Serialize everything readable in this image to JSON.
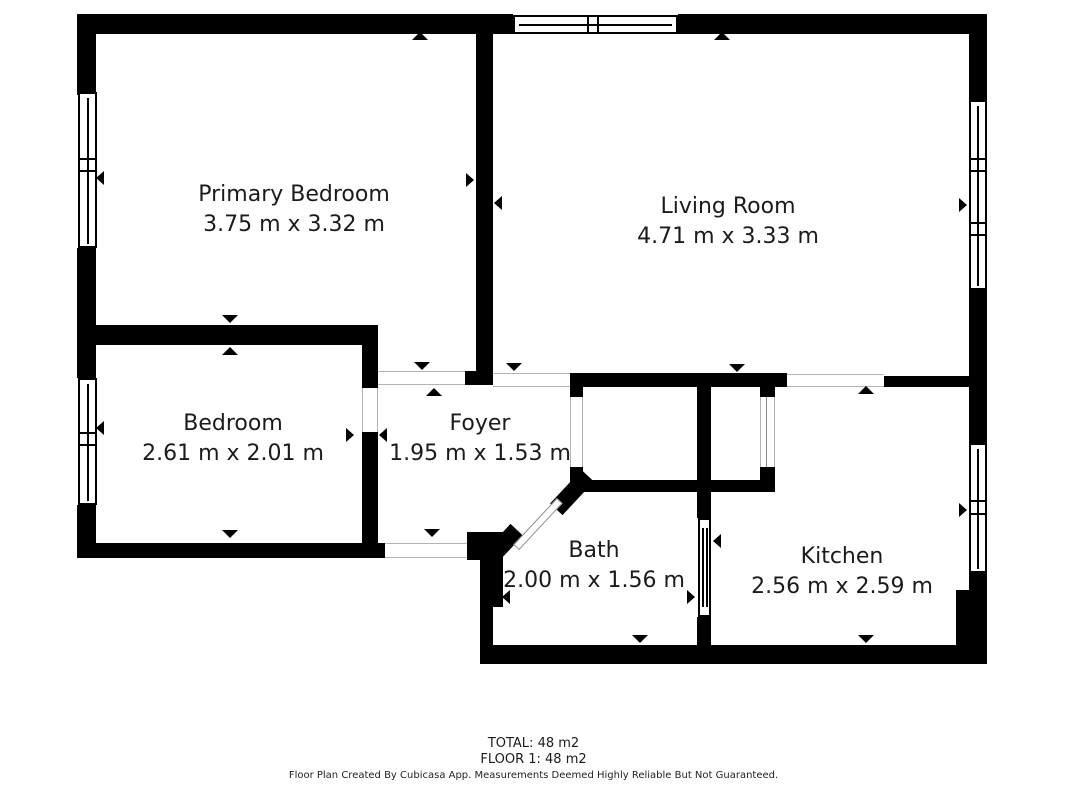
{
  "floorplan": {
    "rooms": [
      {
        "name": "Primary Bedroom",
        "dimensions": "3.75 m x 3.32 m"
      },
      {
        "name": "Living Room",
        "dimensions": "4.71 m x 3.33 m"
      },
      {
        "name": "Bedroom",
        "dimensions": "2.61 m x 2.01 m"
      },
      {
        "name": "Foyer",
        "dimensions": "1.95 m x 1.53 m"
      },
      {
        "name": "Bath",
        "dimensions": "2.00 m x 1.56 m"
      },
      {
        "name": "Kitchen",
        "dimensions": "2.56 m x 2.59 m"
      }
    ],
    "summary": {
      "total": "TOTAL: 48 m2",
      "floor": "FLOOR 1: 48 m2"
    },
    "disclaimer": "Floor Plan Created By Cubicasa App. Measurements Deemed Highly Reliable But Not Guaranteed.",
    "colors": {
      "wall": "#000000",
      "background": "#ffffff",
      "text": "#1b1b1b"
    }
  }
}
